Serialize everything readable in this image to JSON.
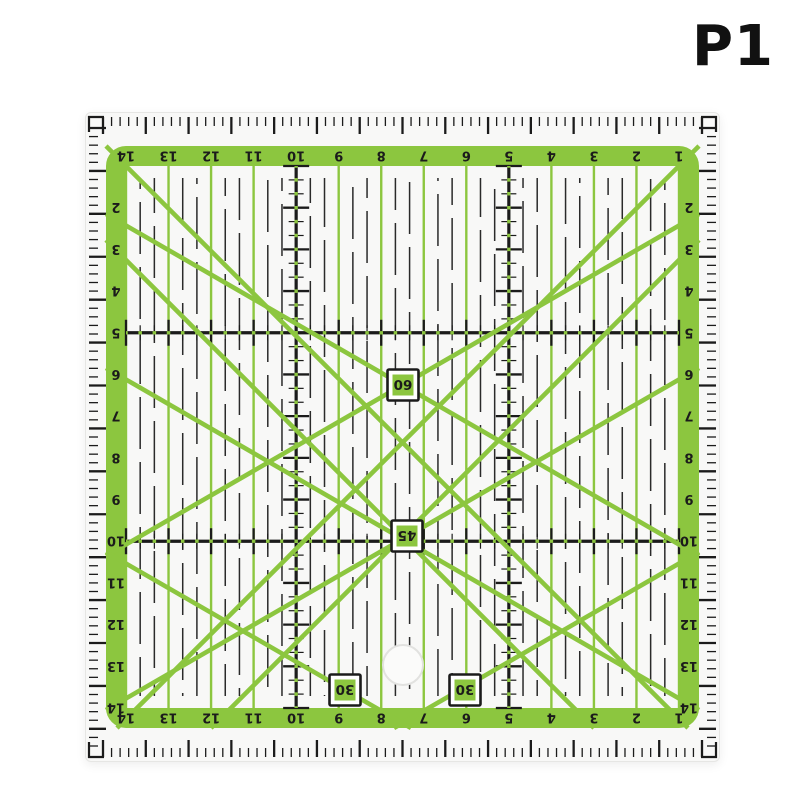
{
  "page": {
    "label": "P1",
    "background": "#ffffff"
  },
  "ruler": {
    "colors": {
      "green": "#8CC63F",
      "ink": "#1b1b1b",
      "dash": "#2a2a2a",
      "body": "#f8f8f7",
      "hole_fill": "#fbfbfa",
      "hole_stroke": "#e2e2e0"
    },
    "scales": {
      "top_numbers": [
        "14",
        "13",
        "12",
        "11",
        "10",
        "9",
        "8",
        "7",
        "6",
        "5",
        "4",
        "3",
        "2",
        "1"
      ],
      "bottom_numbers": [
        "14",
        "13",
        "12",
        "11",
        "10",
        "9",
        "8",
        "7",
        "6",
        "5",
        "4",
        "3",
        "2",
        "1"
      ],
      "left_numbers": [
        "2",
        "3",
        "4",
        "5",
        "6",
        "7",
        "8",
        "9",
        "10",
        "11",
        "12",
        "13",
        "14"
      ],
      "right_numbers": [
        "2",
        "3",
        "4",
        "5",
        "6",
        "7",
        "8",
        "9",
        "10",
        "11",
        "12",
        "13",
        "14"
      ]
    },
    "heavy_rows": [
      5,
      10
    ],
    "heavy_cols": [
      5,
      10
    ],
    "edge_ticks": {
      "short_len": 9,
      "long_len": 17,
      "bold_every": 5
    },
    "angle_labels": [
      {
        "text": "60",
        "x": 318,
        "y": 273
      },
      {
        "text": "45",
        "x": 322,
        "y": 424
      },
      {
        "text": "30",
        "x": 260,
        "y": 578
      },
      {
        "text": "30",
        "x": 380,
        "y": 578
      }
    ],
    "diagonals": [
      [
        21,
        34,
        603,
        616
      ],
      [
        614,
        34,
        32,
        616
      ],
      [
        21,
        128,
        509,
        616
      ],
      [
        614,
        128,
        126,
        616
      ],
      [
        21,
        102,
        614,
        444
      ],
      [
        21,
        444,
        614,
        102
      ],
      [
        21,
        440,
        326,
        616
      ],
      [
        614,
        440,
        309,
        616
      ],
      [
        21,
        256,
        614,
        598
      ],
      [
        614,
        256,
        21,
        598
      ]
    ],
    "hole": {
      "cx": 318,
      "cy": 553,
      "r": 20
    }
  }
}
